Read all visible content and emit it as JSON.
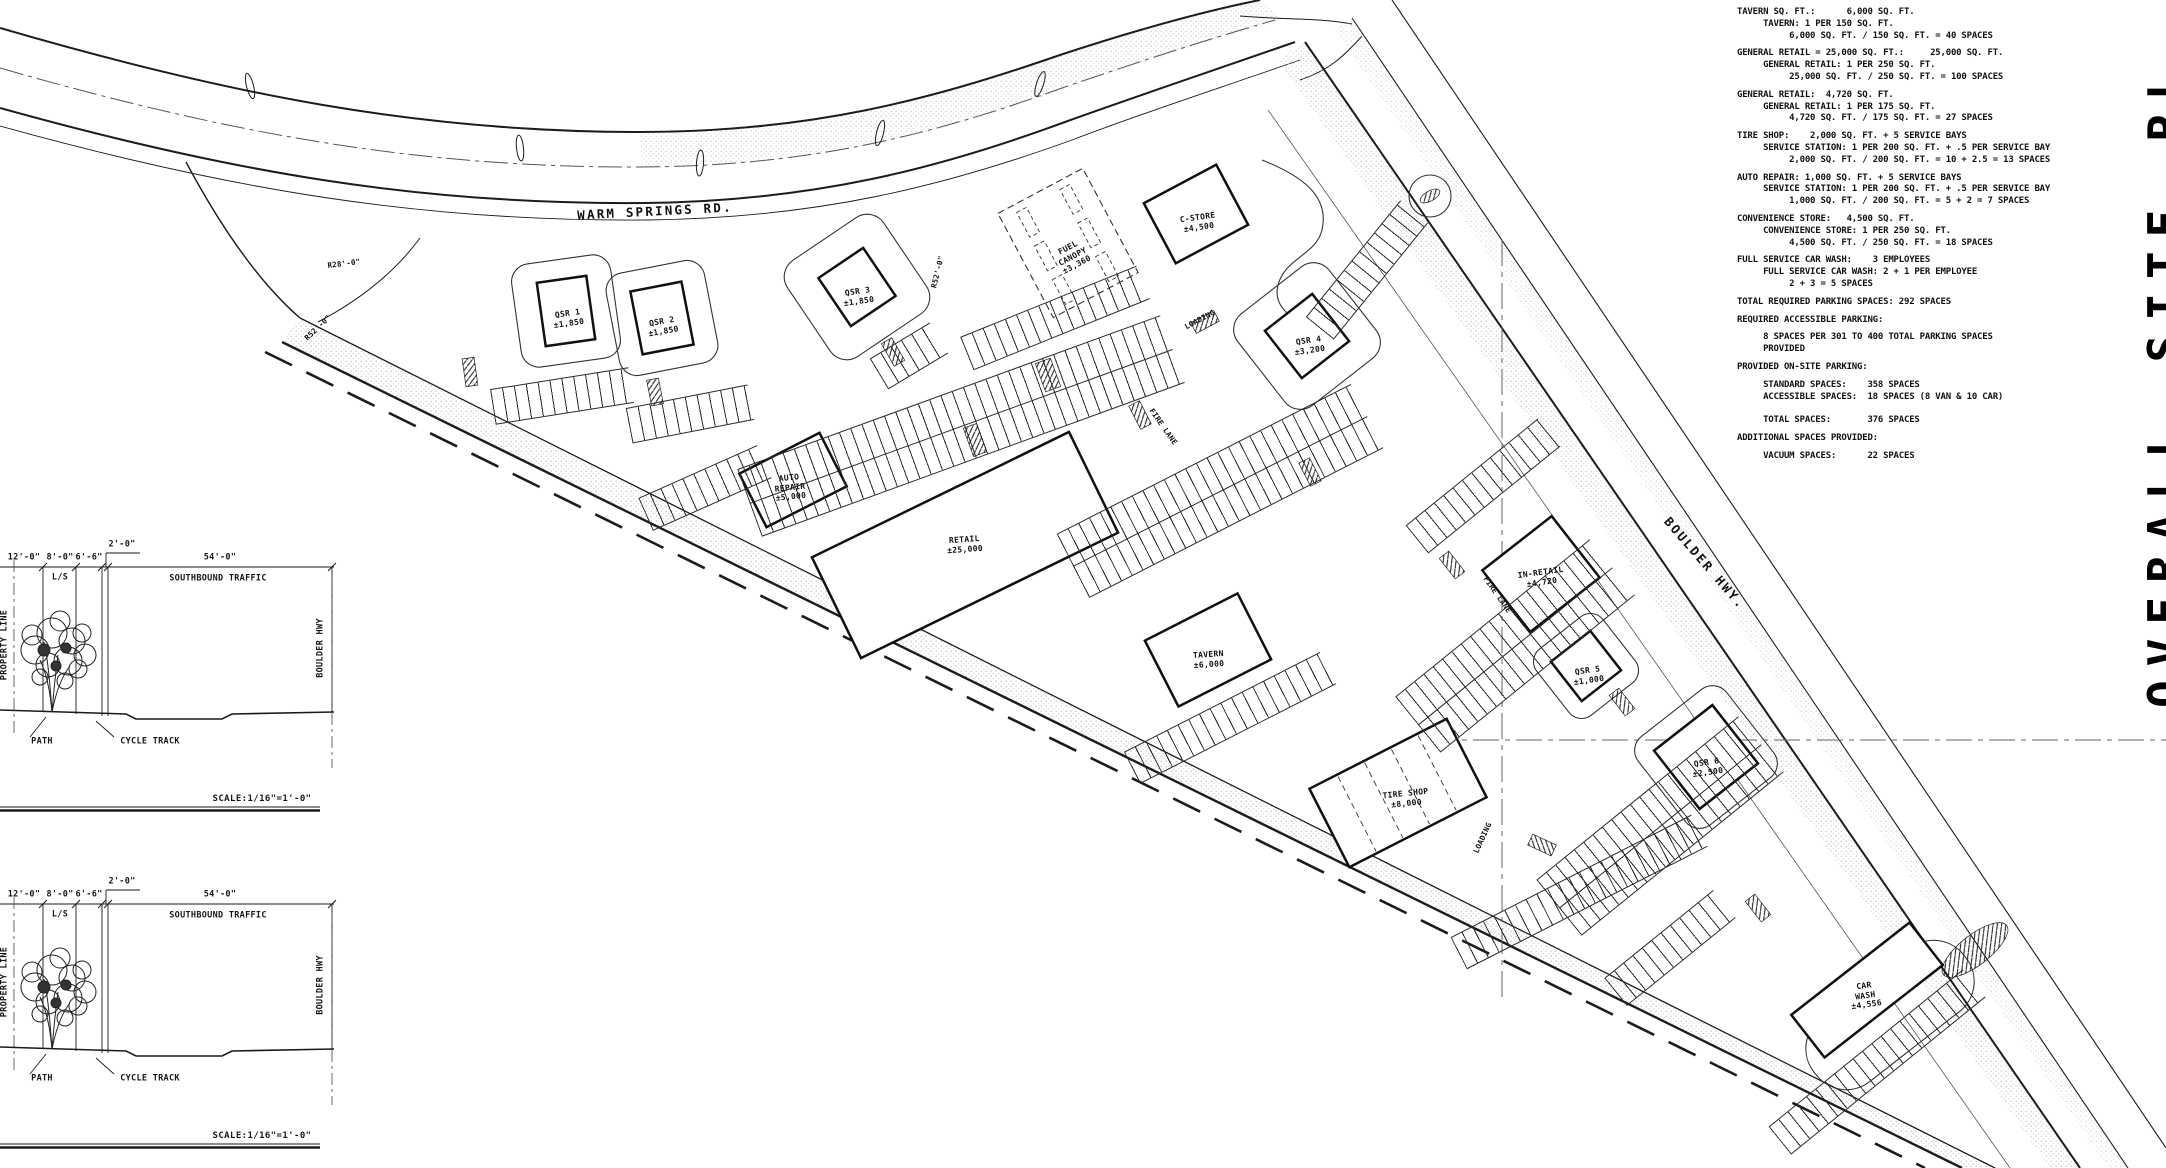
{
  "sheet_title_vertical": "OVERALL SITE PL",
  "roads": {
    "warm_springs": "WARM SPRINGS RD.",
    "boulder_hwy": "BOULDER HWY."
  },
  "radius_labels": {
    "r28": "R28'-0\"",
    "r52": "R52'-0\"",
    "r52b": "R52'-0\""
  },
  "misc_labels": {
    "fire_lane_1": "FIRE LANE",
    "fire_lane_2": "FIRE LANE",
    "loading_1": "LOADING",
    "loading_2": "LOADING"
  },
  "buildings": {
    "qsr1": {
      "name": "QSR 1",
      "area": "±1,850"
    },
    "qsr2": {
      "name": "QSR 2",
      "area": "±1,850"
    },
    "qsr3": {
      "name": "QSR 3",
      "area": "±1,850"
    },
    "fuel": {
      "name": "FUEL CANOPY",
      "area": "±3,360"
    },
    "cstore": {
      "name": "C-STORE",
      "area": "±4,500"
    },
    "qsr4": {
      "name": "QSR 4",
      "area": "±3,200"
    },
    "auto": {
      "name": "AUTO REPAIR",
      "area": "±5,000"
    },
    "retail": {
      "name": "RETAIL",
      "area": "±25,000"
    },
    "tavern": {
      "name": "TAVERN",
      "area": "±6,000"
    },
    "inretail": {
      "name": "IN-RETAIL",
      "area": "±4,720"
    },
    "qsr5": {
      "name": "QSR 5",
      "area": "±1,000"
    },
    "qsr6": {
      "name": "QSR 6",
      "area": "±2,500"
    },
    "tire": {
      "name": "TIRE SHOP",
      "area": "±8,000"
    },
    "carwash": {
      "name": "CAR WASH",
      "area": "±4,556"
    }
  },
  "parking_calcs": {
    "sections": [
      "TAVERN SQ. FT.:      6,000 SQ. FT.\n     TAVERN: 1 PER 150 SQ. FT.\n          6,000 SQ. FT. / 150 SQ. FT. = 40 SPACES",
      "GENERAL RETAIL = 25,000 SQ. FT.:     25,000 SQ. FT.\n     GENERAL RETAIL: 1 PER 250 SQ. FT.\n          25,000 SQ. FT. / 250 SQ. FT. = 100 SPACES",
      "GENERAL RETAIL:  4,720 SQ. FT.\n     GENERAL RETAIL: 1 PER 175 SQ. FT.\n          4,720 SQ. FT. / 175 SQ. FT. = 27 SPACES",
      "TIRE SHOP:    2,000 SQ. FT. + 5 SERVICE BAYS\n     SERVICE STATION: 1 PER 200 SQ. FT. + .5 PER SERVICE BAY\n          2,000 SQ. FT. / 200 SQ. FT. = 10 + 2.5 = 13 SPACES",
      "AUTO REPAIR: 1,000 SQ. FT. + 5 SERVICE BAYS\n     SERVICE STATION: 1 PER 200 SQ. FT. + .5 PER SERVICE BAY\n          1,000 SQ. FT. / 200 SQ. FT. = 5 + 2 = 7 SPACES",
      "CONVENIENCE STORE:   4,500 SQ. FT.\n     CONVENIENCE STORE: 1 PER 250 SQ. FT.\n          4,500 SQ. FT. / 250 SQ. FT. = 18 SPACES",
      "FULL SERVICE CAR WASH:    3 EMPLOYEES\n     FULL SERVICE CAR WASH: 2 + 1 PER EMPLOYEE\n          2 + 3 = 5 SPACES",
      "TOTAL REQUIRED PARKING SPACES: 292 SPACES",
      "REQUIRED ACCESSIBLE PARKING:",
      "     8 SPACES PER 301 TO 400 TOTAL PARKING SPACES\n     PROVIDED",
      "PROVIDED ON-SITE PARKING:",
      "     STANDARD SPACES:    358 SPACES\n     ACCESSIBLE SPACES:  18 SPACES (8 VAN & 10 CAR)\n\n     TOTAL SPACES:       376 SPACES",
      "ADDITIONAL SPACES PROVIDED:",
      "     VACUUM SPACES:      22 SPACES"
    ]
  },
  "section": {
    "dim_12": "12'-0\"",
    "dim_8": "8'-0\"",
    "dim_6": "6'-6\"",
    "dim_2": "2'-0\"",
    "dim_54": "54'-0\"",
    "ls": "L/S",
    "traffic": "SOUTHBOUND TRAFFIC",
    "property_line": "PROPERTY LINE",
    "boulder_hwy": "BOULDER HWY",
    "path": "PATH",
    "cycle_track": "CYCLE TRACK",
    "scale": "SCALE:1/16\"=1'-0\""
  }
}
